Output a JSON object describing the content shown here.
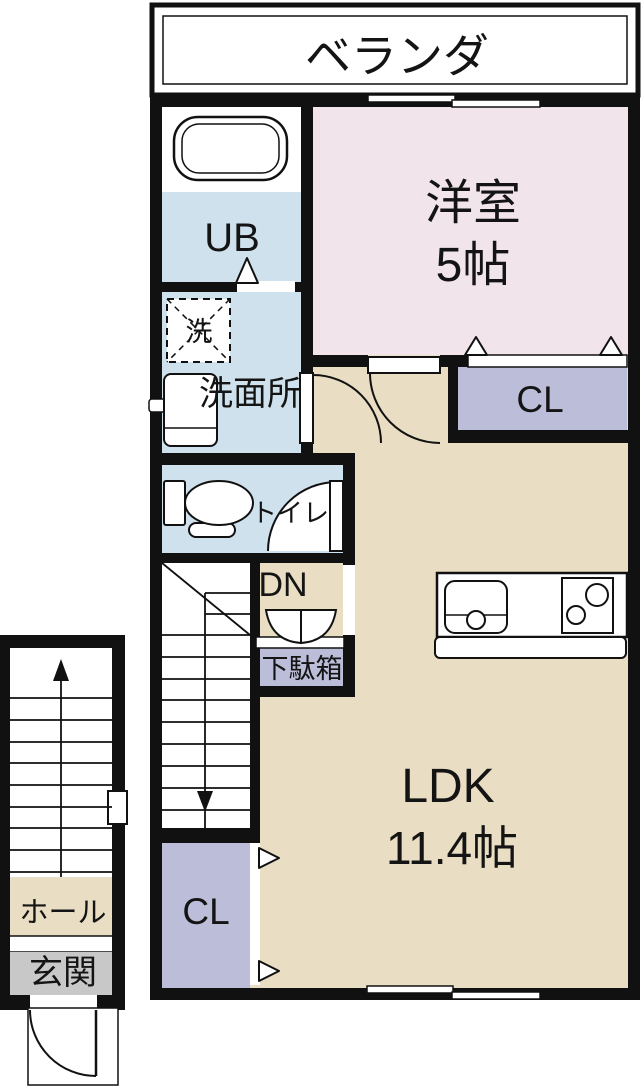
{
  "title": "apartment-floor-plan",
  "rooms": {
    "balcony": {
      "label": "ベランダ"
    },
    "western_room": {
      "label": "洋室",
      "size": "5帖"
    },
    "unit_bath": {
      "label": "UB"
    },
    "washer": {
      "label": "洗"
    },
    "washroom": {
      "label": "洗面所"
    },
    "toilet": {
      "label": "トイレ"
    },
    "stairs_down": {
      "label": "DN"
    },
    "shoe_cabinet": {
      "label": "下駄箱"
    },
    "closet_upper": {
      "label": "CL"
    },
    "ldk": {
      "label": "LDK",
      "size": "11.4帖"
    },
    "closet_lower": {
      "label": "CL"
    },
    "hall": {
      "label": "ホール"
    },
    "entrance": {
      "label": "玄関"
    }
  },
  "colors": {
    "wall": "#111111",
    "western_room_pink": "#f2e4eb",
    "wet_area_blue": "#cfe1ec",
    "ldk_beige": "#e9dec3",
    "closet_lavender": "#bcbdd8",
    "entrance_gray": "#c8c8c8",
    "background": "#ffffff"
  }
}
